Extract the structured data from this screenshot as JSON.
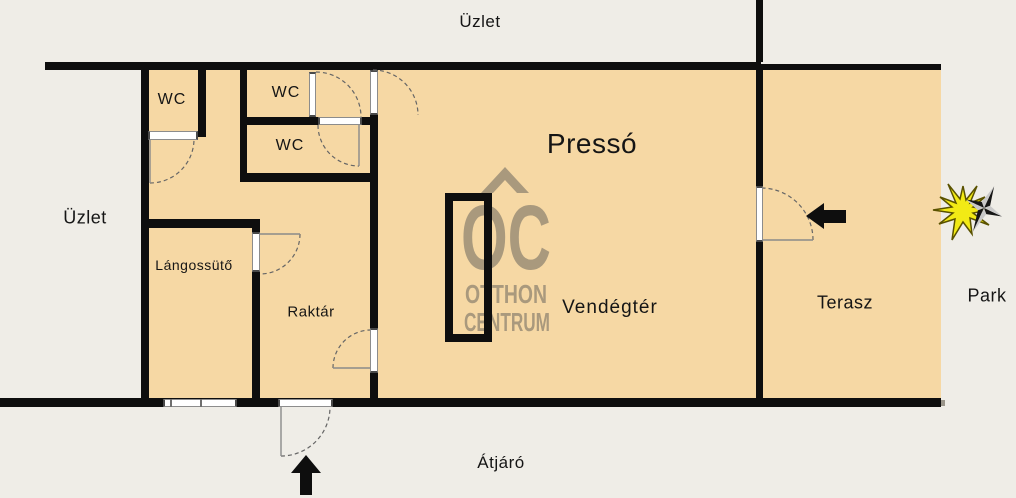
{
  "plan": {
    "exterior_labels": {
      "shop_top": "Üzlet",
      "shop_left": "Üzlet",
      "passage_bottom": "Átjáró",
      "park_right": "Park"
    },
    "rooms": {
      "presso": "Pressó",
      "wc1": "WC",
      "wc2": "WC",
      "wc3": "WC",
      "langossuto": "Lángossütő",
      "raktar": "Raktár",
      "vendegter": "Vendégtér",
      "terasz": "Terasz"
    },
    "watermark": {
      "monogram": "OC",
      "line1": "OTTHON",
      "line2": "CENTRUM",
      "roof_icon": "house-roof-icon"
    },
    "icons": {
      "entrance_arrow": "arrow-up",
      "terrace_arrow": "arrow-left",
      "compass": "north-star-compass"
    },
    "colors": {
      "background": "#efede7",
      "floor": "#f6d8a4",
      "wall": "#0e0e0e",
      "watermark": "#a3947a",
      "compass_yellow": "#f2ea15",
      "door_frame": "#8c8c8c"
    }
  }
}
